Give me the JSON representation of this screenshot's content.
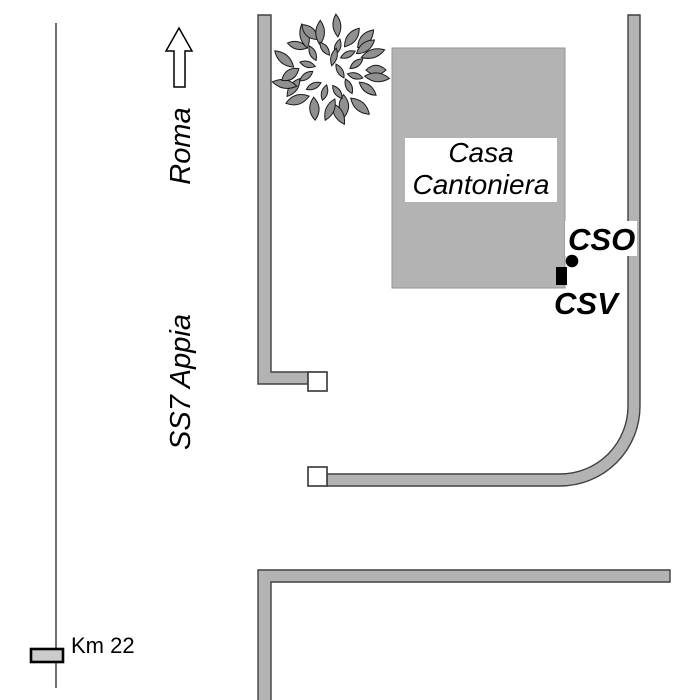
{
  "labels": {
    "destination": "Roma",
    "road": "SS7 Appia",
    "km_marker": "Km 22",
    "building_line1": "Casa",
    "building_line2": "Cantoniera",
    "point_cso": "CSO",
    "point_csv": "CSV"
  },
  "colors": {
    "background": "#ffffff",
    "road_fill": "#b3b3b3",
    "road_outline": "#404040",
    "thin_road_line": "#4d4d4d",
    "building_fill": "#b3b3b3",
    "building_outline": "#969696",
    "tree_leaf_fill": "#909090",
    "km_marker_fill": "#cccccc",
    "point_marker_color": "#000000",
    "text_color": "#000000"
  },
  "icons": {
    "direction_arrow": "up-arrow",
    "tree": "tree-crown-ring",
    "cso_point": "filled-circle",
    "csv_point": "filled-rectangle",
    "gates": "white-square"
  }
}
